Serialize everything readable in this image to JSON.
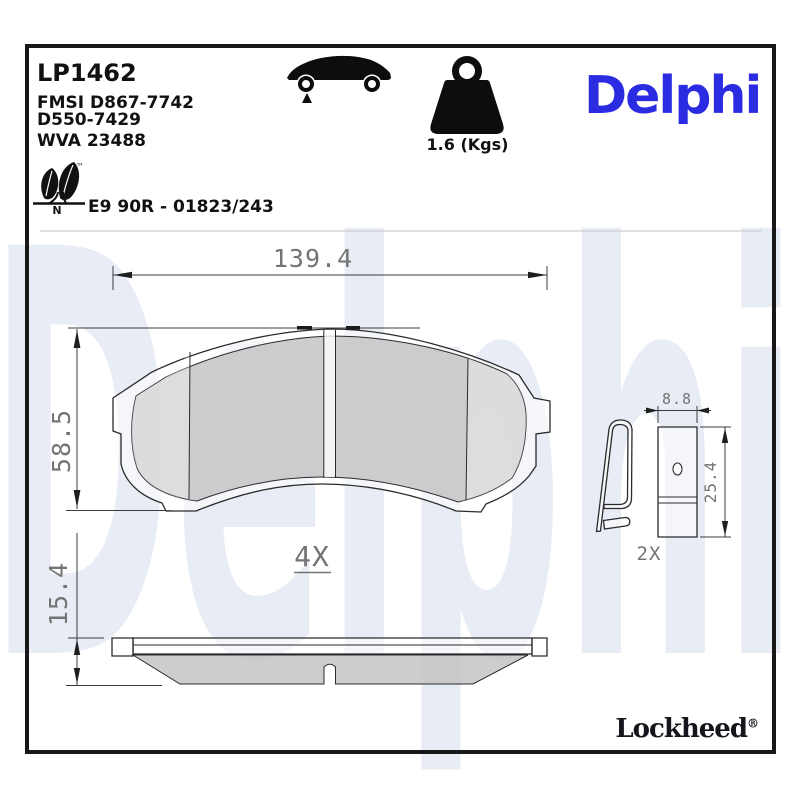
{
  "header": {
    "part_number": "LP1462",
    "fmsi_ref": "FMSI D867-7742",
    "fmsi_ref2": "D550-7429",
    "wva_ref": "WVA 23488",
    "homologation": "E9 90R - 01823/243",
    "eco_mark_letter": "N",
    "trademark": "™",
    "weight_label": "1.6 (Kgs)",
    "brand": "Delphi"
  },
  "icons": {
    "car": "car-side-silhouette",
    "weight": "weight-kettlebell",
    "eco_leaf": "leaf-trademark"
  },
  "watermark": {
    "text": "Delphi"
  },
  "drawing": {
    "front_view": {
      "width_mm": "139.4",
      "height_mm": "58.5"
    },
    "side_view": {
      "thickness_mm": "15.4",
      "quantity": "4X"
    },
    "shim_clip": {
      "width_mm": "8.8",
      "height_mm": "25.4",
      "quantity": "2X"
    }
  },
  "footer": {
    "brand": "Lockheed",
    "registered": "®"
  },
  "colors": {
    "brand_blue": "#2b2be2",
    "watermark_blue": "#e8ecf4",
    "friction_gray": "#c4c4c6",
    "outline_black": "#2b2b2b",
    "dim_gray": "#747474",
    "divider_gray": "#c6c6c6"
  }
}
